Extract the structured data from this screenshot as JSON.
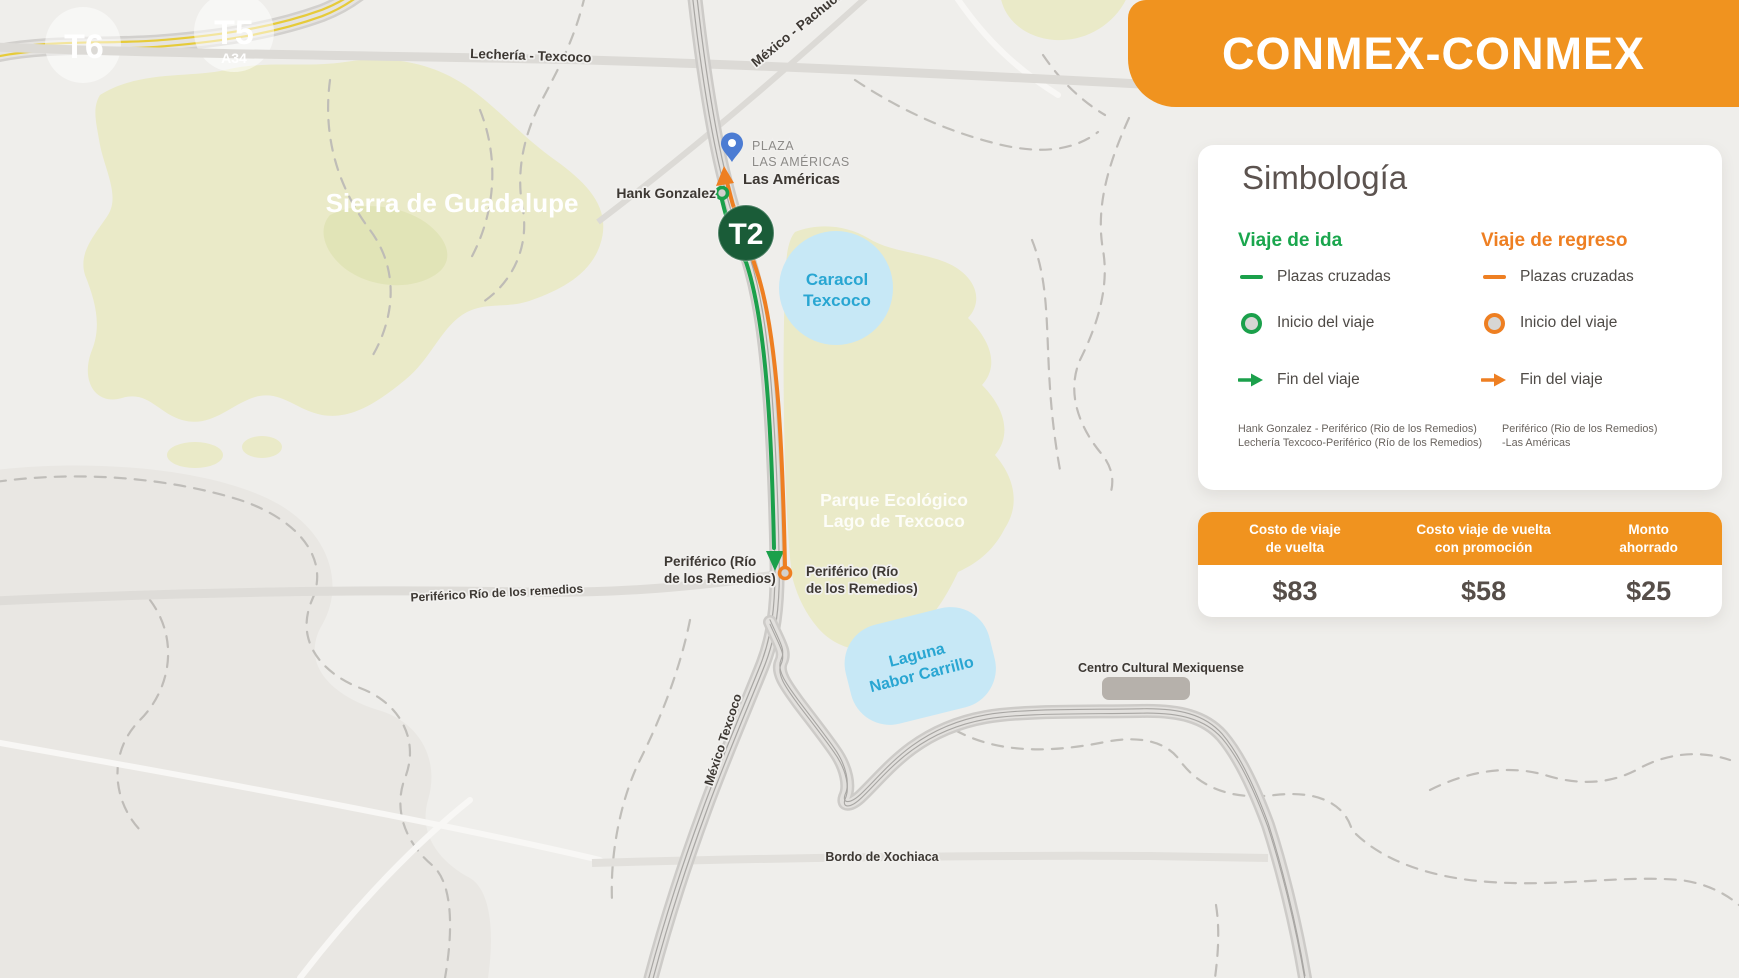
{
  "header": {
    "title": "CONMEX-CONMEX"
  },
  "colors": {
    "brand_orange": "#F0931F",
    "route_green": "#1BA04B",
    "route_orange": "#EE7F22",
    "badge_green": "#1A5C38",
    "water_fill": "#C7E8F6",
    "water_text": "#29A6D2",
    "region_green": "#EAEAC8",
    "pin_blue": "#4C7CD3"
  },
  "legend": {
    "title": "Simbología",
    "columns": [
      {
        "title": "Viaje de ida",
        "items": [
          "Plazas cruzadas",
          "Inicio del viaje",
          "Fin del viaje"
        ],
        "footnote_line1": "Hank Gonzalez - Periférico (Rio de los Remedios)",
        "footnote_line2": "Lechería Texcoco-Periférico (Río de los Remedios)"
      },
      {
        "title": "Viaje de regreso",
        "items": [
          "Plazas cruzadas",
          "Inicio del viaje",
          "Fin del viaje"
        ],
        "footnote_line1": "Periférico (Rio de los Remedios)",
        "footnote_line2": "-Las Américas"
      }
    ]
  },
  "cost_table": {
    "columns": [
      {
        "header": "Costo de viaje\nde vuelta",
        "value": "$83"
      },
      {
        "header": "Costo viaje de vuelta\ncon promoción",
        "value": "$58"
      },
      {
        "header": "Monto\nahorrado",
        "value": "$25"
      }
    ]
  },
  "map": {
    "badges": {
      "t6": "T6",
      "t5": "T5",
      "t5_sub": "A34",
      "t2": "T2"
    },
    "roads": {
      "lecheria": "Lechería - Texcoco",
      "mexico_pachuca": "México - Pachuca",
      "periferico_rio": "Periférico Río de los remedios",
      "mexico_texcoco": "México Texcoco",
      "bordo": "Bordo de Xochiaca"
    },
    "places": {
      "sierra": "Sierra de Guadalupe",
      "caracol_line1": "Caracol",
      "caracol_line2": "Texcoco",
      "parque_line1": "Parque Ecológico",
      "parque_line2": "Lago de Texcoco",
      "laguna_line1": "Laguna",
      "laguna_line2": "Nabor Carrillo",
      "centro_cultural": "Centro Cultural Mexiquense",
      "plaza_line1": "PLAZA",
      "plaza_line2": "LAS AMÉRICAS",
      "las_americas": "Las Américas",
      "hank_gonzalez": "Hank Gonzalez",
      "periferico_left_line1": "Periférico (Río",
      "periferico_left_line2": "de los Remedios)",
      "periferico_right_line1": "Periférico (Río",
      "periferico_right_line2": "de los Remedios)"
    }
  }
}
